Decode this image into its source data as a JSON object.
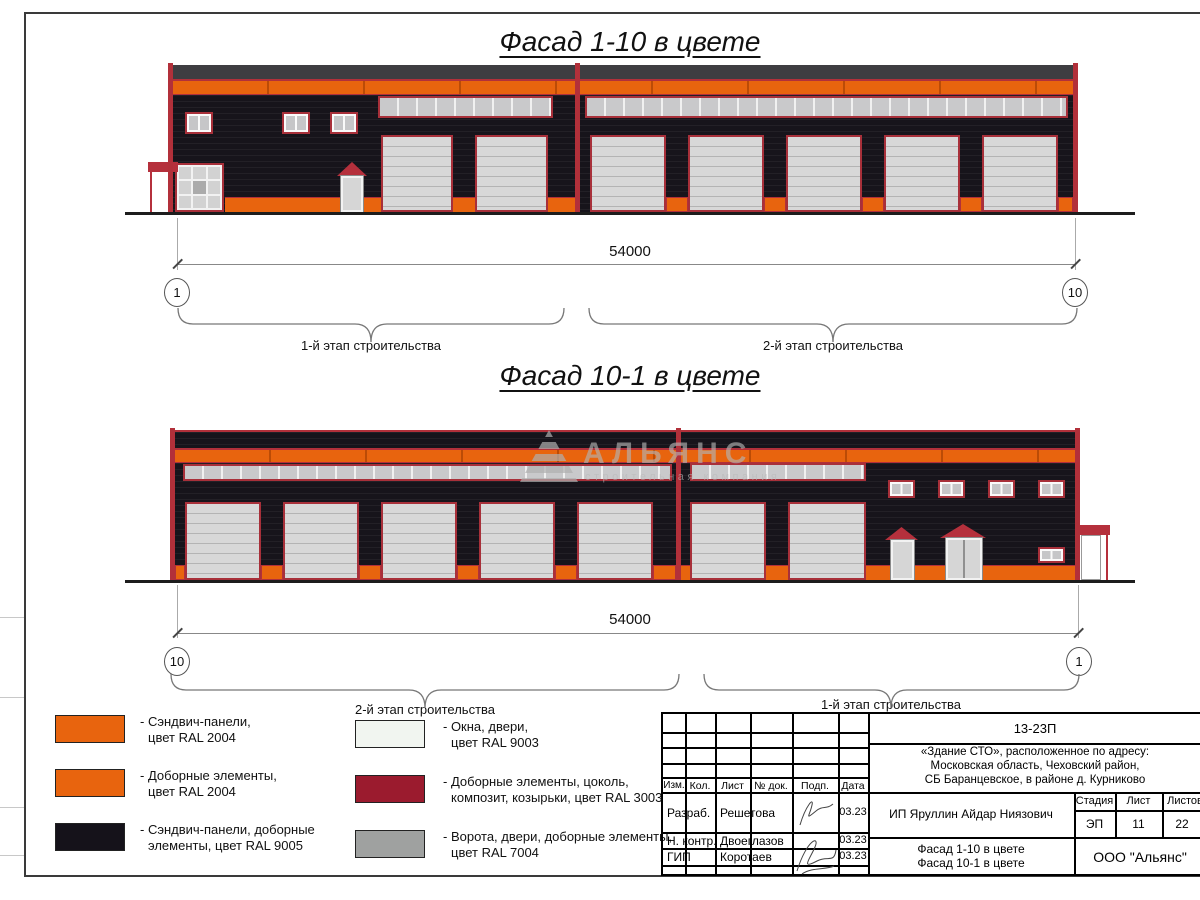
{
  "titles": {
    "facade1": "Фасад 1-10 в цвете",
    "facade2": "Фасад 10-1 в цвете"
  },
  "facade1_dim": {
    "length": "54000",
    "axis_left": "1",
    "axis_right": "10",
    "brace_left_label": "1-й этап строительства",
    "brace_right_label": "2-й этап строительства"
  },
  "facade2_dim": {
    "length": "54000",
    "axis_left": "10",
    "axis_right": "1",
    "brace_left_label": "2-й этап строительства",
    "brace_right_label": "1-й этап строительства"
  },
  "watermark": {
    "name": "АЛЬЯНС",
    "subtitle": "строительная компания"
  },
  "legend": [
    {
      "line1": "- Сэндвич-панели,",
      "line2": "цвет RAL 2004",
      "color": "#E8640E"
    },
    {
      "line1": "- Доборные элементы,",
      "line2": "цвет RAL 2004",
      "color": "#E8640E"
    },
    {
      "line1": "- Сэндвич-панели, доборные",
      "line2": "элементы, цвет RAL 9005",
      "color": "#15121A"
    },
    {
      "line1": "- Окна, двери,",
      "line2": "цвет RAL 9003",
      "color": "#F1F5F0"
    },
    {
      "line1": "- Доборные элементы, цоколь,",
      "line2": "композит, козырьки, цвет RAL 3003",
      "color": "#9B1B2E"
    },
    {
      "line1": "- Ворота, двери, доборные элементы,",
      "line2": "цвет RAL 7004",
      "color": "#9FA1A0"
    }
  ],
  "title_block": {
    "code": "13-23П",
    "address1": "«Здание СТО», расположенное по адресу:",
    "address2": "Московская область, Чеховский район,",
    "address3": "СБ Баранцевское, в районе д. Курниково",
    "col_headers": [
      "Изм.",
      "Кол.",
      "Лист",
      "№ док.",
      "Подп.",
      "Дата"
    ],
    "rows": [
      {
        "role": "Разраб.",
        "name": "Решетова",
        "date": "03.23"
      },
      {
        "role": "Н. контр.",
        "name": "Двоеглазов",
        "date": "03.23"
      },
      {
        "role": "ГИП",
        "name": "Коротаев",
        "date": "03.23"
      }
    ],
    "client": "ИП Яруллин Айдар Ниязович",
    "stage_label": "Стадия",
    "sheet_label": "Лист",
    "sheets_label": "Листов",
    "stage": "ЭП",
    "sheet": "11",
    "sheets": "22",
    "doc_title1": "Фасад 1-10 в цвете",
    "doc_title2": "Фасад 10-1 в цвете",
    "company": "ООО \"Альянс\""
  },
  "colors": {
    "sandwich_orange_ral2004": "#E8640E",
    "black_ral9005": "#15121A",
    "red_ral3003": "#A8303A",
    "door_gray_ral7004": "#9FA1A0",
    "window_white_ral9003": "#F1F5F0"
  }
}
